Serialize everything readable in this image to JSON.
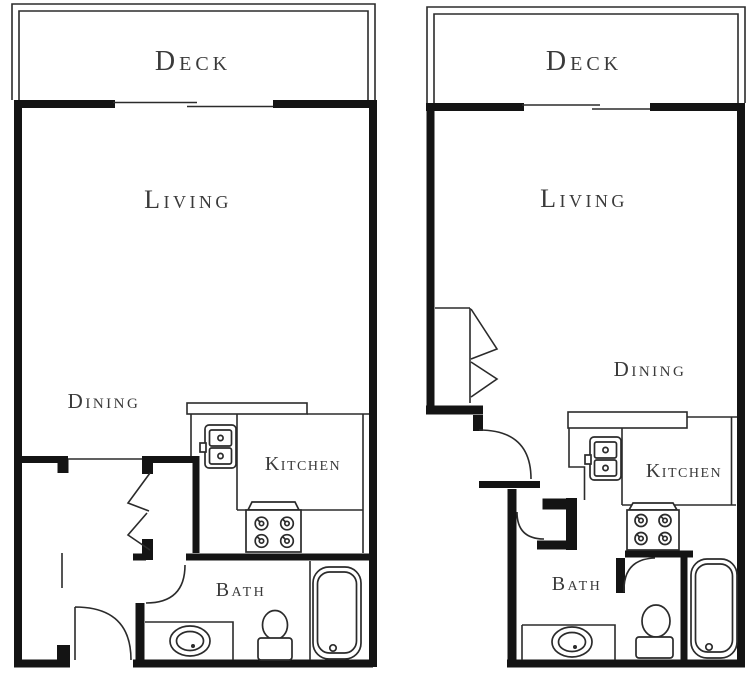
{
  "colors": {
    "ink": "#141414",
    "line": "#2b2b2b",
    "label": "#3a3a3a",
    "background": "#ffffff"
  },
  "plans": [
    {
      "name": "left-unit",
      "rooms": {
        "deck": "Deck",
        "living": "Living",
        "dining": "Dining",
        "kitchen": "Kitchen",
        "bath": "Bath"
      },
      "fixtures": [
        "sliding-glass-door",
        "bifold-closet-door",
        "entry-door",
        "bath-door",
        "kitchen-sink",
        "stove",
        "vanity-sink",
        "toilet",
        "bathtub"
      ]
    },
    {
      "name": "right-unit",
      "rooms": {
        "deck": "Deck",
        "living": "Living",
        "dining": "Dining",
        "kitchen": "Kitchen",
        "bath": "Bath"
      },
      "fixtures": [
        "sliding-glass-door",
        "bifold-closet-door",
        "entry-door",
        "bath-door",
        "kitchen-sink",
        "stove",
        "vanity-sink",
        "toilet",
        "bathtub"
      ]
    }
  ]
}
